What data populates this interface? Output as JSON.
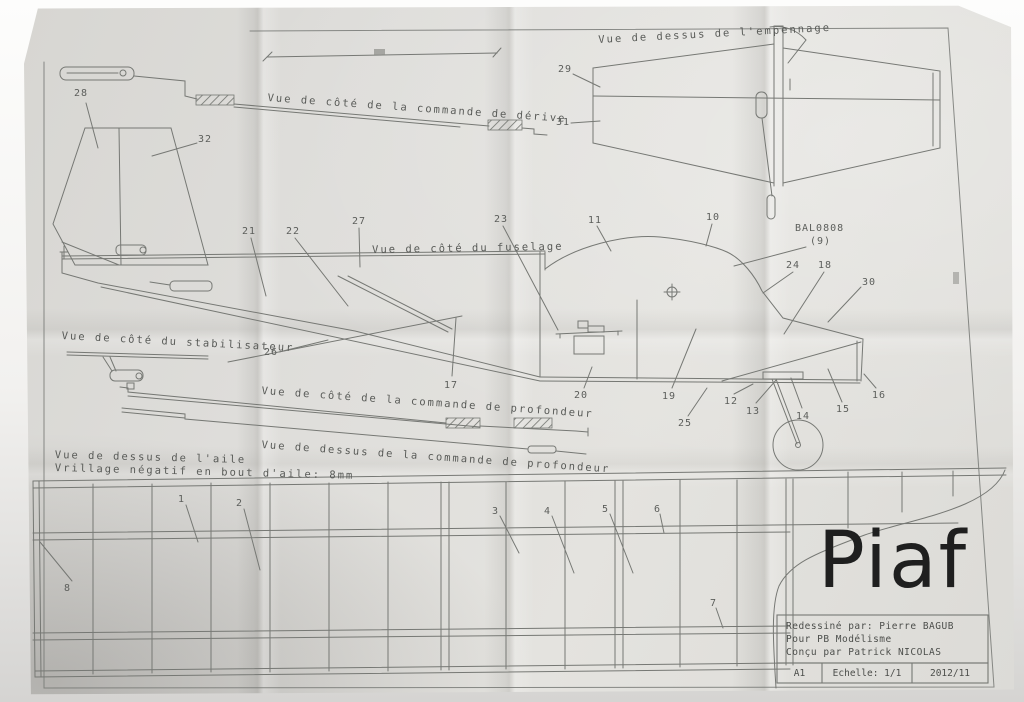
{
  "titles": {
    "empennage_top": "Vue de dessus de l'empennage",
    "derive_side": "Vue de côté de la commande de dérive",
    "fuselage_side": "Vue de côté du fuselage",
    "stab_side": "Vue de côté du stabilisateur",
    "profondeur_side": "Vue de côté de la commande de profondeur",
    "profondeur_top": "Vue de dessus de la commande de profondeur",
    "wing_top": "Vue de dessus de l'aile",
    "wing_note": "Vrillage négatif en bout d'aile: 8mm"
  },
  "annotations": {
    "balsa_ref": "BAL0808",
    "balsa_qty": "(9)"
  },
  "callouts": {
    "1": "1",
    "2": "2",
    "3": "3",
    "4": "4",
    "5": "5",
    "6": "6",
    "7": "7",
    "8": "8",
    "10": "10",
    "11": "11",
    "12": "12",
    "13": "13",
    "14": "14",
    "15": "15",
    "16": "16",
    "17": "17",
    "18": "18",
    "19": "19",
    "20": "20",
    "21": "21",
    "22": "22",
    "23": "23",
    "24": "24",
    "25": "25",
    "26": "26",
    "27": "27",
    "28": "28",
    "29": "29",
    "30": "30",
    "31": "31",
    "32": "32"
  },
  "title_block": {
    "model_name": "Piaf",
    "line1": "Redessiné par: Pierre BAGUB",
    "line2": "Pour PB Modélisme",
    "line3": "Conçu par Patrick NICOLAS",
    "format": "A1",
    "scale": "Echelle: 1/1",
    "date": "2012/11"
  },
  "colors": {
    "paper": "#dedddA",
    "ink": "#767874",
    "title_ink": "#1f1f1f"
  }
}
